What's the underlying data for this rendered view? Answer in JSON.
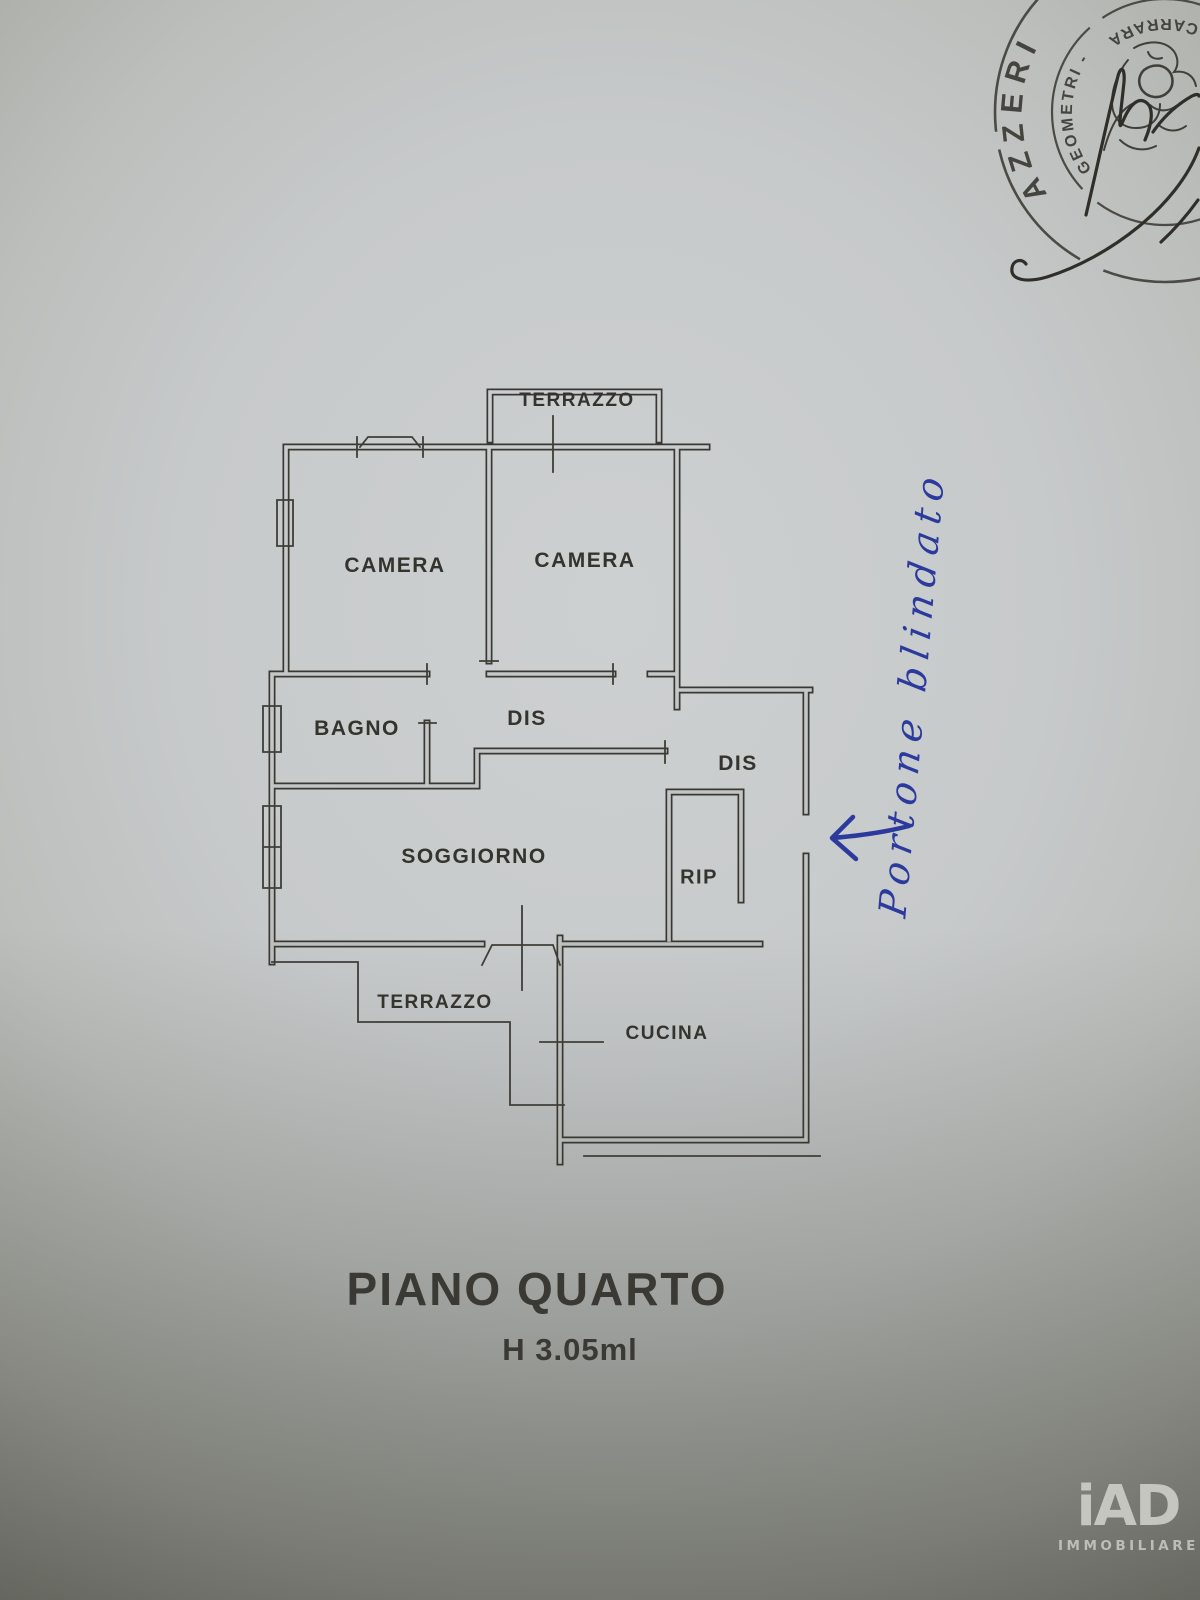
{
  "plan": {
    "ink_color": "#3a3833",
    "labels": [
      {
        "id": "terrazzo-top",
        "text": "TERRAZZO"
      },
      {
        "id": "camera-left",
        "text": "CAMERA"
      },
      {
        "id": "camera-right",
        "text": "CAMERA"
      },
      {
        "id": "bagno",
        "text": "BAGNO"
      },
      {
        "id": "dis-center",
        "text": "DIS"
      },
      {
        "id": "dis-right",
        "text": "DIS"
      },
      {
        "id": "soggiorno",
        "text": "SOGGIORNO"
      },
      {
        "id": "rip",
        "text": "RIP"
      },
      {
        "id": "terrazzo-bottom",
        "text": "TERRAZZO"
      },
      {
        "id": "cucina",
        "text": "CUCINA"
      }
    ]
  },
  "title": {
    "floor": "PIANO QUARTO",
    "height": "H 3.05ml"
  },
  "annotation": {
    "text": "Portone blindato",
    "ink_color": "#2b3a9c"
  },
  "stamp": {
    "outer_text": "AZZERI",
    "inner_text_1": "GEOMETRI -",
    "inner_text_2": "- CARRARA -"
  },
  "logo": {
    "brand": "iAD",
    "subtitle": "IMMOBILIARE"
  }
}
